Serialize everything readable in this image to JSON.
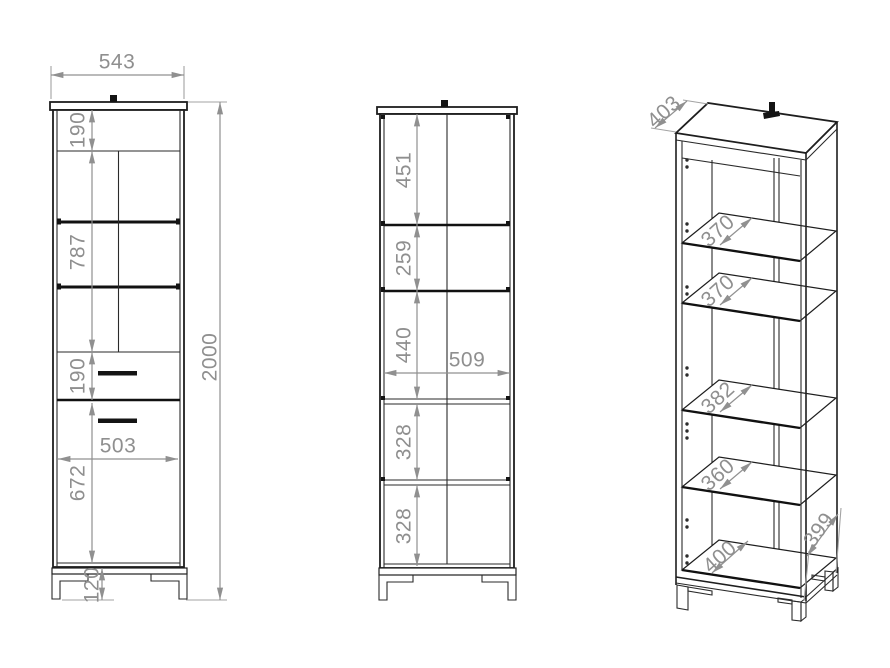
{
  "drawing": {
    "title": "Tall cabinet technical drawing - three views",
    "colors": {
      "line": "#1e1e1e",
      "dimension": "#8f8f8f",
      "background": "#ffffff"
    },
    "views": {
      "front": {
        "name": "front view with doors",
        "width": "543",
        "total_height": "2000",
        "top_section_height": "190",
        "glass_section_height": "787",
        "drawer_height": "190",
        "door_width": "503",
        "door_height": "672",
        "leg_height": "120"
      },
      "interior": {
        "name": "front view interior sections",
        "sections": [
          "451",
          "259",
          "440",
          "328",
          "328"
        ],
        "inner_width": "509"
      },
      "perspective": {
        "name": "isometric view with shelves",
        "top_depth": "403",
        "shelf_depths": [
          "370",
          "370",
          "382",
          "360"
        ],
        "bottom_inner_width": "400",
        "bottom_side_depth": "399"
      }
    }
  }
}
